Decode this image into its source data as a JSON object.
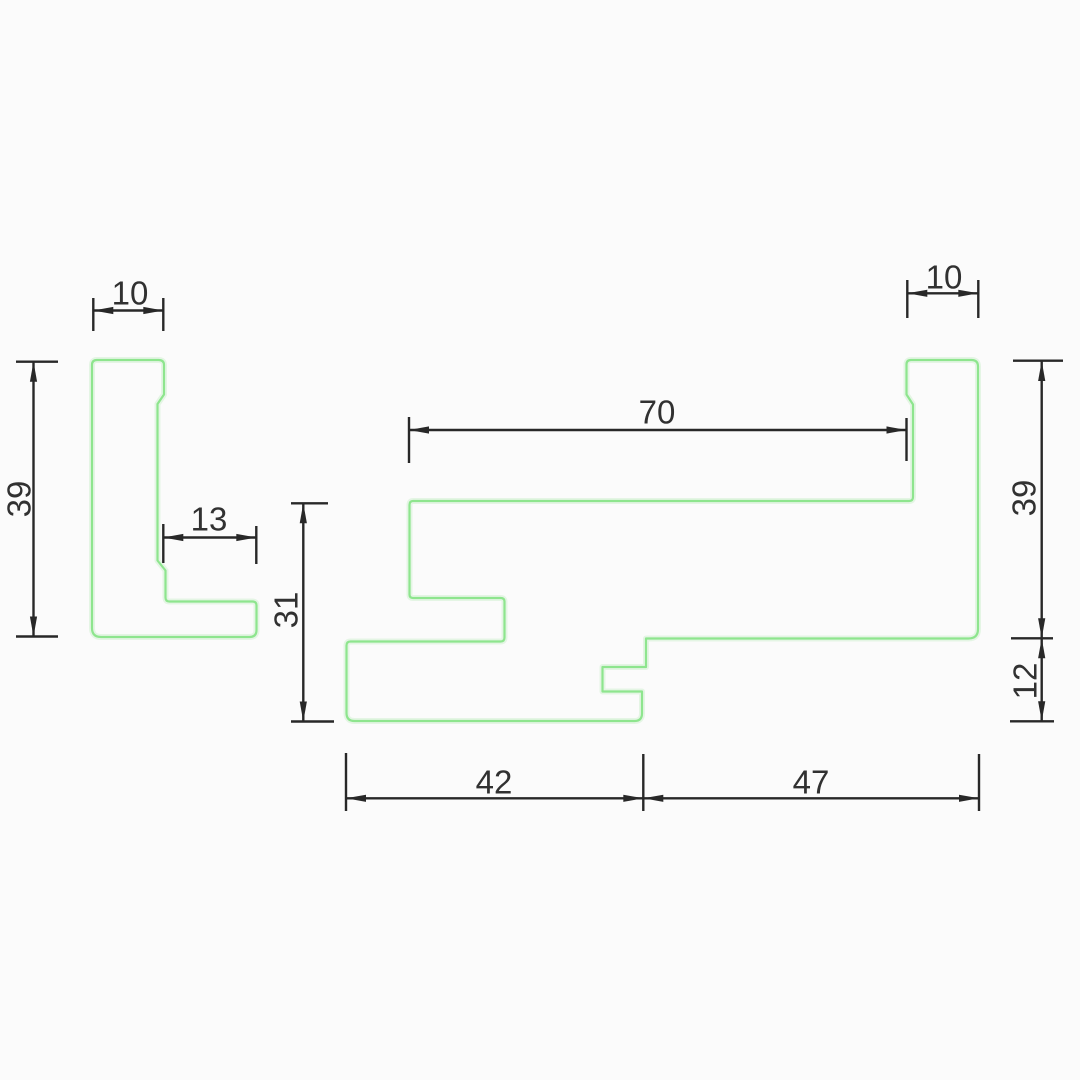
{
  "document": {
    "kind": "technical-profile-drawing",
    "canvas": {
      "width": 1080,
      "height": 1080,
      "background": "#fbfbfb"
    }
  },
  "style": {
    "profile_stroke": "#8ee58e",
    "profile_glow": "#b9ecb9",
    "profile_stroke_width": 2.2,
    "profile_glow_width": 6,
    "dim_color": "#282828",
    "dim_stroke_width": 2.4,
    "text_color": "#313131",
    "font_size": 33,
    "arrow_length": 20,
    "arrow_half_width": 3.6
  },
  "profiles": [
    {
      "name": "left-profile",
      "path": "M 97 360 L 158.5 360 Q 164 360 164 365 L 164 394.5 L 157.5 404 L 157.5 560.5 L 165.5 570.5 L 165.5 597.5 Q 165.5 601.5 169.5 601.5 L 252.5 601.5 Q 256.5 601.5 256.5 605.5 L 256.5 630 Q 256.5 637 249.5 637 L 101 637 Q 92 637 92 628 L 92 365 Q 92 360 97 360 Z"
    },
    {
      "name": "main-profile",
      "path": "M 413 501 L 909 501 Q 913 501 913 497 L 913 404.5 L 906.5 394.5 L 906.5 364.5 Q 906.5 360 911 360 L 971.5 360 Q 978 360 978 366.5 L 978 629 Q 978 638.5 968.5 638.5 L 646 638.5 L 646 667 L 602.5 667 L 602.5 691.5 L 642 691.5 L 642 713.5 Q 642 721 634.5 721 L 354.5 721 Q 346.5 721 346.5 713 L 346.5 645.5 Q 346.5 641.5 350.5 641.5 L 500.5 641.5 Q 504.5 641.5 504.5 637.5 L 504.5 601.5 Q 504.5 598 500.5 598 L 413 598 Q 409.5 598 409.5 594.5 L 409.5 505 Q 409.5 501 413 501 Z"
    }
  ],
  "dimensions": [
    {
      "name": "left-bar-width",
      "label": "10",
      "line": {
        "x1": 93.3,
        "y1": 310.5,
        "x2": 163.3,
        "y2": 310.5
      },
      "ext": [
        [
          93.3,
          298,
          93.3,
          331
        ],
        [
          163.3,
          298,
          163.3,
          331
        ]
      ],
      "arrows": [
        {
          "x": 93.3,
          "y": 310.5,
          "dir": "left"
        },
        {
          "x": 163.3,
          "y": 310.5,
          "dir": "right"
        }
      ],
      "label_pos": {
        "x": 130,
        "y": 293
      },
      "rotated": false
    },
    {
      "name": "left-height",
      "label": "39",
      "line": {
        "x1": 33.5,
        "y1": 361.7,
        "x2": 33.5,
        "y2": 636.5
      },
      "ext": [
        [
          16,
          361.7,
          58,
          361.7
        ],
        [
          16,
          636.5,
          58,
          636.5
        ]
      ],
      "arrows": [
        {
          "x": 33.5,
          "y": 361.7,
          "dir": "up"
        },
        {
          "x": 33.5,
          "y": 636.5,
          "dir": "down"
        }
      ],
      "label_pos": {
        "x": 19,
        "y": 499
      },
      "rotated": true
    },
    {
      "name": "left-foot-width",
      "label": "13",
      "line": {
        "x1": 163.3,
        "y1": 537.5,
        "x2": 256.3,
        "y2": 537.5
      },
      "ext": [
        [
          163.3,
          524,
          163.3,
          563
        ],
        [
          256.3,
          526,
          256.3,
          564
        ]
      ],
      "arrows": [
        {
          "x": 163.3,
          "y": 537.5,
          "dir": "left"
        },
        {
          "x": 256.3,
          "y": 537.5,
          "dir": "right"
        }
      ],
      "label_pos": {
        "x": 209,
        "y": 519
      },
      "rotated": false
    },
    {
      "name": "step-height",
      "label": "31",
      "line": {
        "x1": 303.3,
        "y1": 503.3,
        "x2": 303.3,
        "y2": 721.5
      },
      "ext": [
        [
          291,
          503.3,
          328,
          503.3
        ],
        [
          291,
          721.5,
          334,
          721.5
        ]
      ],
      "arrows": [
        {
          "x": 303.3,
          "y": 503.3,
          "dir": "up"
        },
        {
          "x": 303.3,
          "y": 721.5,
          "dir": "down"
        }
      ],
      "label_pos": {
        "x": 286,
        "y": 610
      },
      "rotated": true
    },
    {
      "name": "top-width",
      "label": "70",
      "line": {
        "x1": 409,
        "y1": 430,
        "x2": 906.5,
        "y2": 430
      },
      "ext": [
        [
          409,
          417,
          409,
          463
        ],
        [
          906.5,
          418,
          906.5,
          461
        ]
      ],
      "arrows": [
        {
          "x": 409,
          "y": 430,
          "dir": "left"
        },
        {
          "x": 906.5,
          "y": 430,
          "dir": "right"
        }
      ],
      "label_pos": {
        "x": 657,
        "y": 412
      },
      "rotated": false
    },
    {
      "name": "right-bar-width",
      "label": "10",
      "line": {
        "x1": 907.3,
        "y1": 293.3,
        "x2": 978.3,
        "y2": 293.3
      },
      "ext": [
        [
          907.3,
          280,
          907.3,
          318
        ],
        [
          978.3,
          280,
          978.3,
          318
        ]
      ],
      "arrows": [
        {
          "x": 907.3,
          "y": 293.3,
          "dir": "left"
        },
        {
          "x": 978.3,
          "y": 293.3,
          "dir": "right"
        }
      ],
      "label_pos": {
        "x": 944,
        "y": 277
      },
      "rotated": false
    },
    {
      "name": "right-height",
      "label": "39",
      "line": {
        "x1": 1041.7,
        "y1": 361,
        "x2": 1041.7,
        "y2": 638.3
      },
      "ext": [
        [
          1013,
          360.7,
          1063,
          360.7
        ],
        [
          1011,
          638.3,
          1053,
          638.3
        ]
      ],
      "arrows": [
        {
          "x": 1041.7,
          "y": 361,
          "dir": "up"
        },
        {
          "x": 1041.7,
          "y": 638.3,
          "dir": "down"
        }
      ],
      "label_pos": {
        "x": 1024,
        "y": 498
      },
      "rotated": true
    },
    {
      "name": "right-lip-height",
      "label": "12",
      "line": {
        "x1": 1041.7,
        "y1": 638.3,
        "x2": 1041.7,
        "y2": 721.3
      },
      "ext": [
        [
          1010,
          721.3,
          1054,
          721.3
        ]
      ],
      "arrows": [
        {
          "x": 1041.7,
          "y": 638.3,
          "dir": "up"
        },
        {
          "x": 1041.7,
          "y": 721.3,
          "dir": "down"
        }
      ],
      "label_pos": {
        "x": 1025,
        "y": 681
      },
      "rotated": true
    },
    {
      "name": "bottom-left-width",
      "label": "42",
      "line": {
        "x1": 346,
        "y1": 798.3,
        "x2": 643.3,
        "y2": 798.3
      },
      "ext": [
        [
          346,
          753,
          346,
          811
        ],
        [
          643.3,
          754,
          643.3,
          811
        ]
      ],
      "arrows": [
        {
          "x": 346,
          "y": 798.3,
          "dir": "left"
        },
        {
          "x": 643.3,
          "y": 798.3,
          "dir": "right"
        }
      ],
      "label_pos": {
        "x": 494,
        "y": 782
      },
      "rotated": false
    },
    {
      "name": "bottom-right-width",
      "label": "47",
      "line": {
        "x1": 643.3,
        "y1": 798.3,
        "x2": 979,
        "y2": 798.3
      },
      "ext": [
        [
          979,
          754,
          979,
          811
        ]
      ],
      "arrows": [
        {
          "x": 643.3,
          "y": 798.3,
          "dir": "left"
        },
        {
          "x": 979,
          "y": 798.3,
          "dir": "right"
        }
      ],
      "label_pos": {
        "x": 811,
        "y": 782
      },
      "rotated": false
    }
  ]
}
